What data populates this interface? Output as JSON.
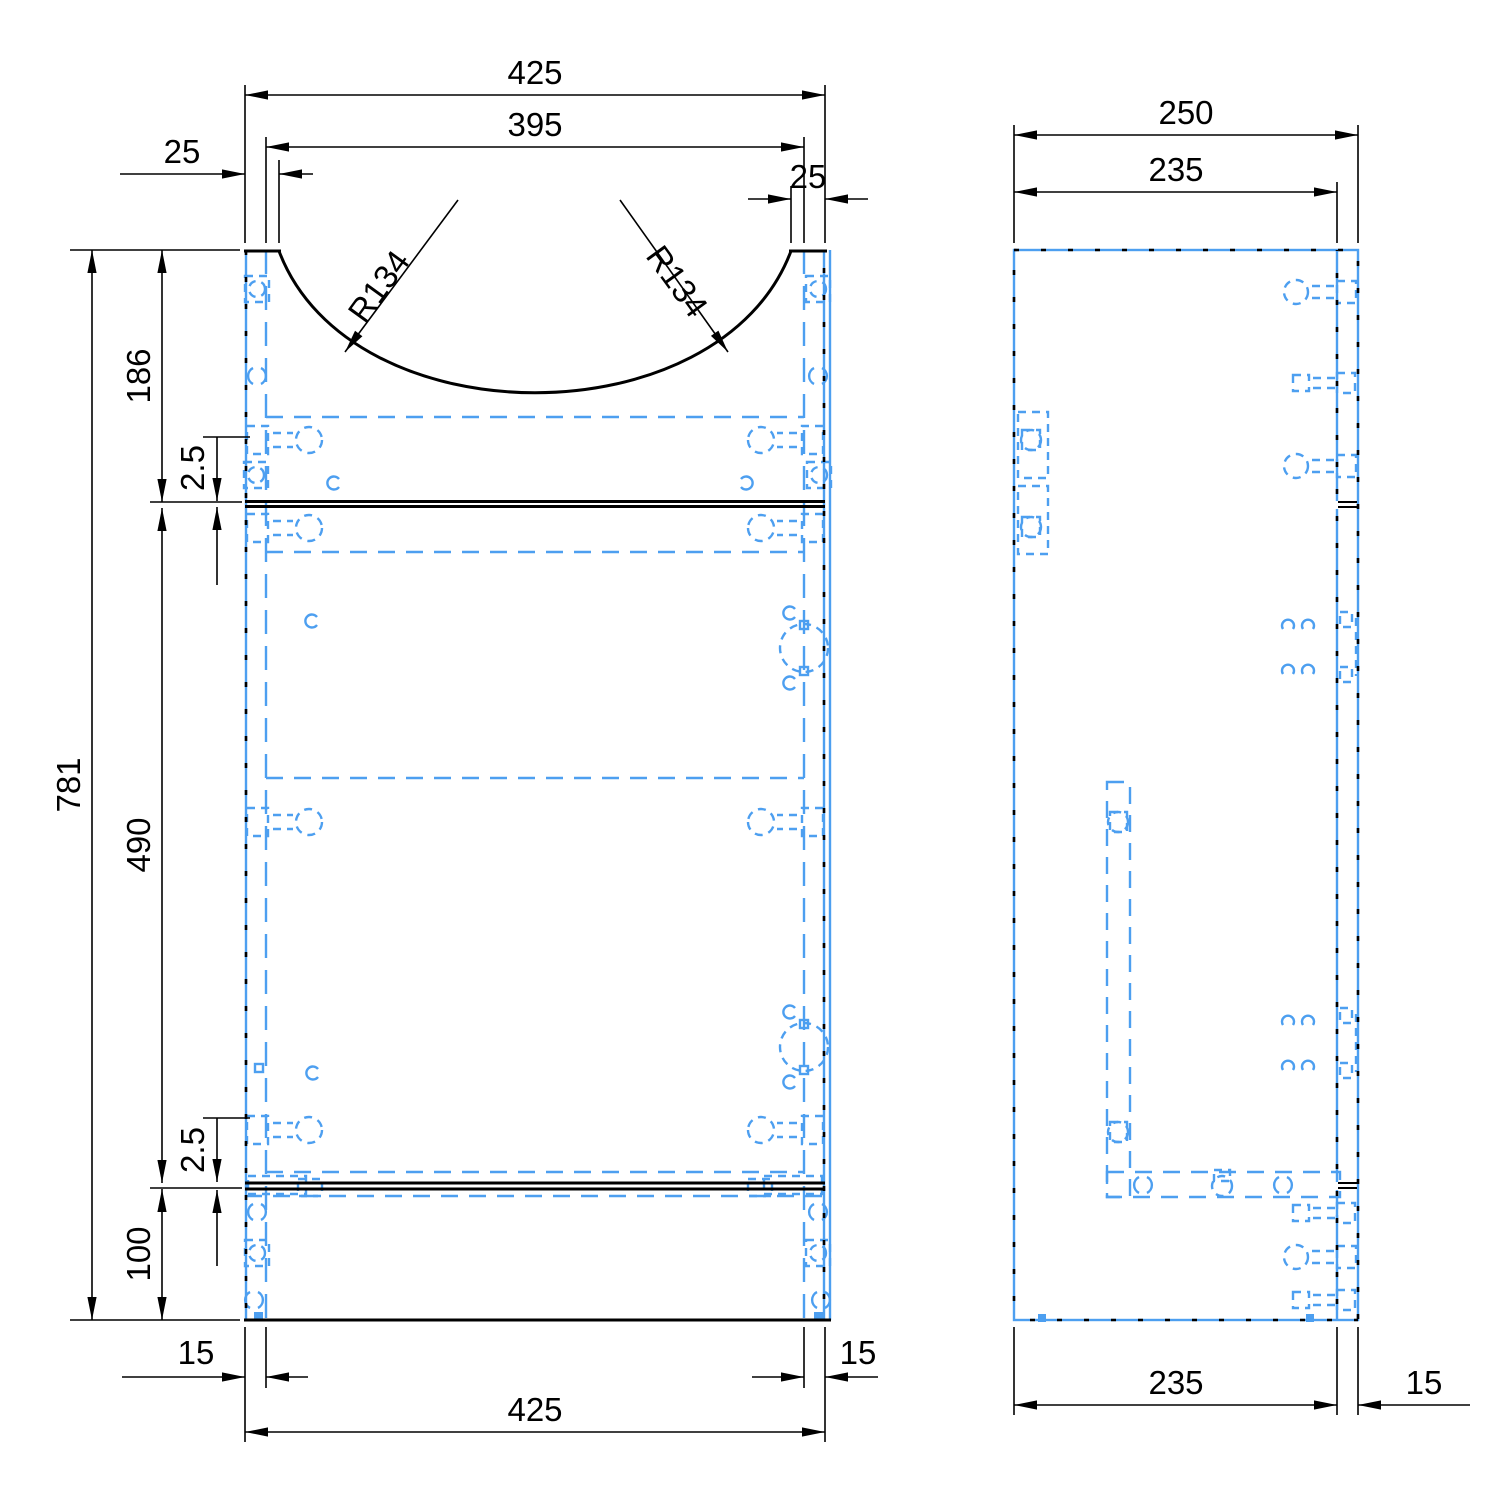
{
  "drawing": {
    "title": "Vanity unit carcass drawing",
    "description": "Dimensioned CAD front and side views of a basin vanity cabinet with dashed blue hardware fittings",
    "colors": {
      "outline": "#000000",
      "hardware_blue": "#4d9ff0",
      "background": "#ffffff"
    },
    "front_view": {
      "dims": {
        "total_width_top": "425",
        "basin_cutout_width": "395",
        "basin_inset_left": "25",
        "basin_inset_right": "25",
        "basin_radius_left": "R134",
        "basin_radius_right": "R134",
        "total_height": "781",
        "top_section_height": "186",
        "top_shelf_thickness": "2.5",
        "middle_section_height": "490",
        "bottom_shelf_thickness": "2.5",
        "plinth_height": "100",
        "panel_thickness_bottom_left": "15",
        "total_width_bottom": "425",
        "panel_thickness_bottom_right": "15"
      }
    },
    "side_view": {
      "dims": {
        "total_depth": "250",
        "carcass_depth_top": "235",
        "carcass_depth_bottom": "235",
        "front_panel_thickness": "15"
      }
    }
  }
}
